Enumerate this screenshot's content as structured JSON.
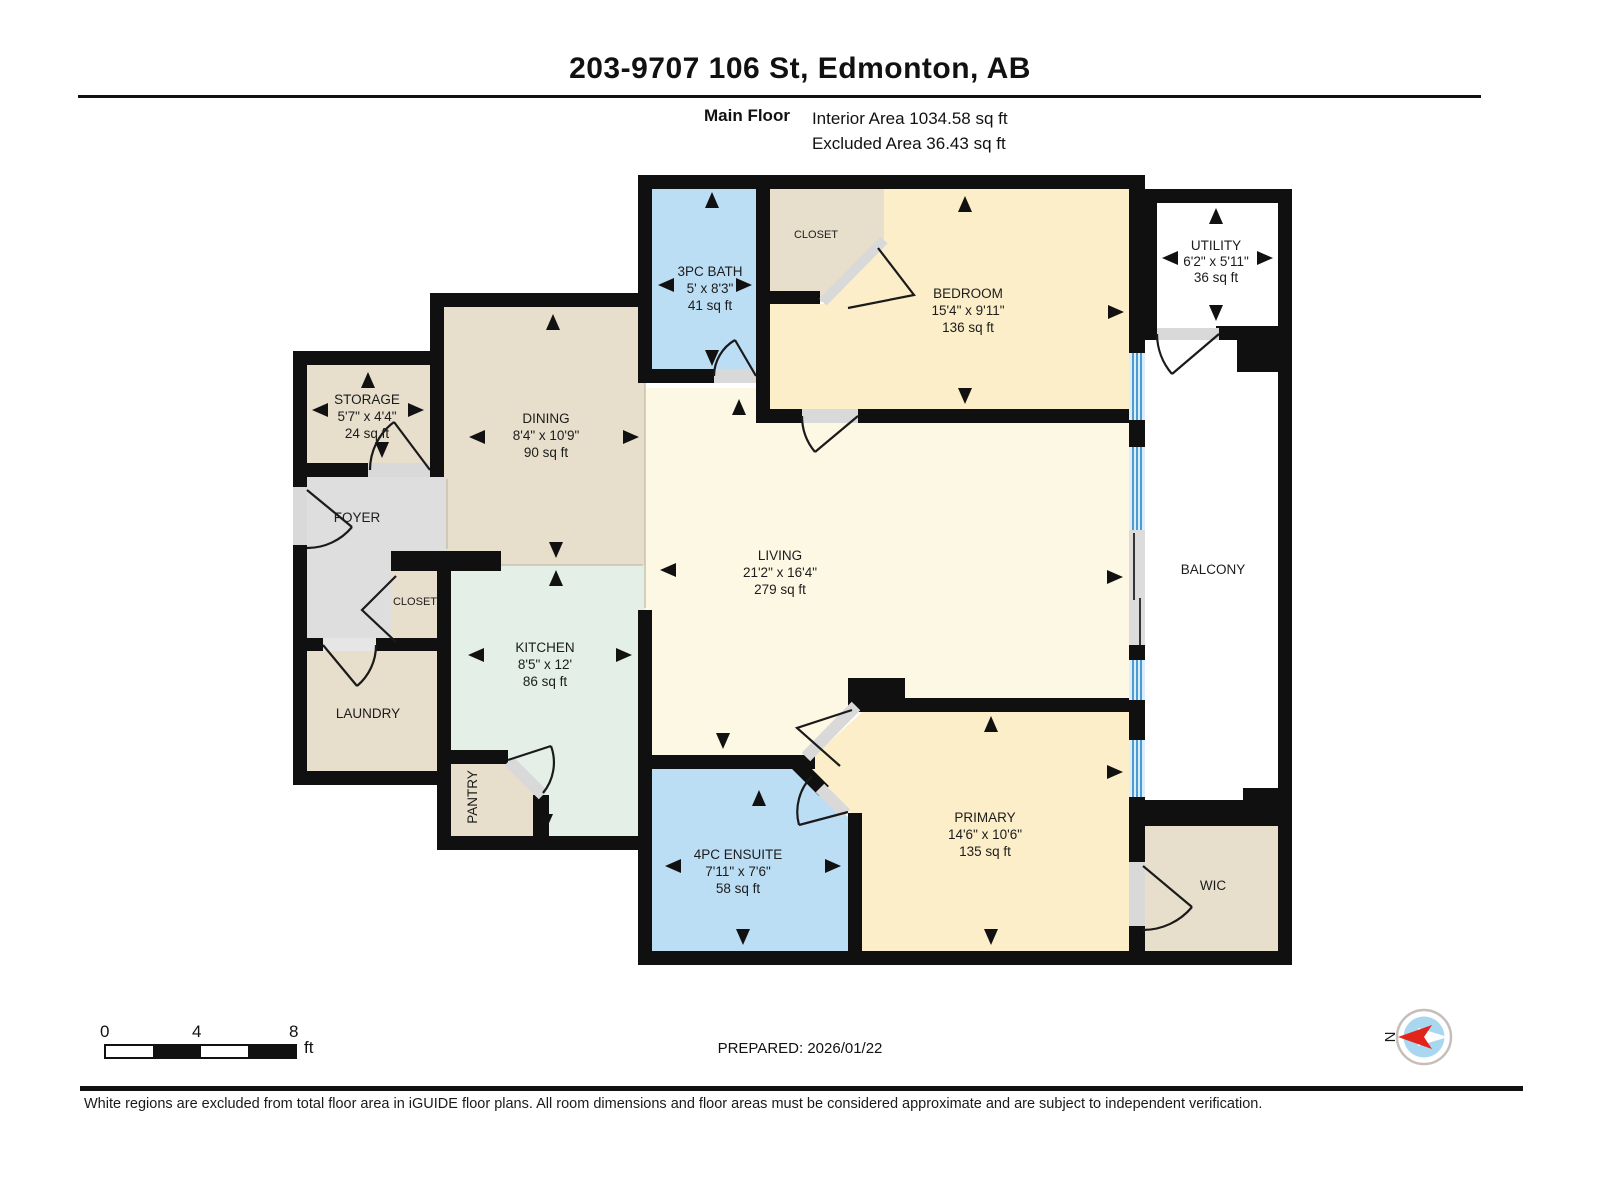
{
  "header": {
    "title": "203-9707 106 St, Edmonton, AB",
    "floor_label": "Main Floor",
    "interior_area": "Interior Area 1034.58 sq ft",
    "excluded_area": "Excluded Area 36.43 sq ft"
  },
  "rooms": {
    "bath": {
      "name": "3PC BATH",
      "dims": "5' x 8'3\"",
      "area": "41 sq ft"
    },
    "closet_top": {
      "name": "CLOSET"
    },
    "bedroom": {
      "name": "BEDROOM",
      "dims": "15'4\" x 9'11\"",
      "area": "136 sq ft"
    },
    "utility": {
      "name": "UTILITY",
      "dims": "6'2\" x 5'11\"",
      "area": "36 sq ft"
    },
    "storage": {
      "name": "STORAGE",
      "dims": "5'7\" x 4'4\"",
      "area": "24 sq ft"
    },
    "dining": {
      "name": "DINING",
      "dims": "8'4\" x 10'9\"",
      "area": "90 sq ft"
    },
    "foyer": {
      "name": "FOYER"
    },
    "closet_mid": {
      "name": "CLOSET"
    },
    "kitchen": {
      "name": "KITCHEN",
      "dims": "8'5\" x 12'",
      "area": "86 sq ft"
    },
    "laundry": {
      "name": "LAUNDRY"
    },
    "pantry": {
      "name": "PANTRY"
    },
    "living": {
      "name": "LIVING",
      "dims": "21'2\" x 16'4\"",
      "area": "279 sq ft"
    },
    "ensuite": {
      "name": "4PC ENSUITE",
      "dims": "7'11\" x 7'6\"",
      "area": "58 sq ft"
    },
    "primary": {
      "name": "PRIMARY",
      "dims": "14'6\" x 10'6\"",
      "area": "135 sq ft"
    },
    "wic": {
      "name": "WIC"
    },
    "balcony": {
      "name": "BALCONY"
    }
  },
  "scale_bar": {
    "tick_0": "0",
    "tick_4": "4",
    "tick_8": "8",
    "unit": "ft"
  },
  "prepared_label": "PREPARED: 2026/01/22",
  "compass": {
    "north_label": "N"
  },
  "footer": {
    "disclaimer": "White regions are excluded from total floor area in iGUIDE floor plans. All room dimensions and floor areas must be considered approximate and are subject to independent verification."
  },
  "colors": {
    "wall": "#101010",
    "bath_blue": "#bcdef5",
    "bedroom_yellow": "#fbeec8",
    "living_cream": "#fdf8e4",
    "tan": "#e7decb",
    "kitchen_mint": "#e4f0e7",
    "foyer_gray": "#dedede",
    "excluded_white": "#ffffff",
    "window_blue": "#4a9cd4",
    "window_light": "#ddeefa",
    "door_sill": "#d9d9d9",
    "compass_red": "#e1251b",
    "compass_blue": "#a9d7ef"
  }
}
